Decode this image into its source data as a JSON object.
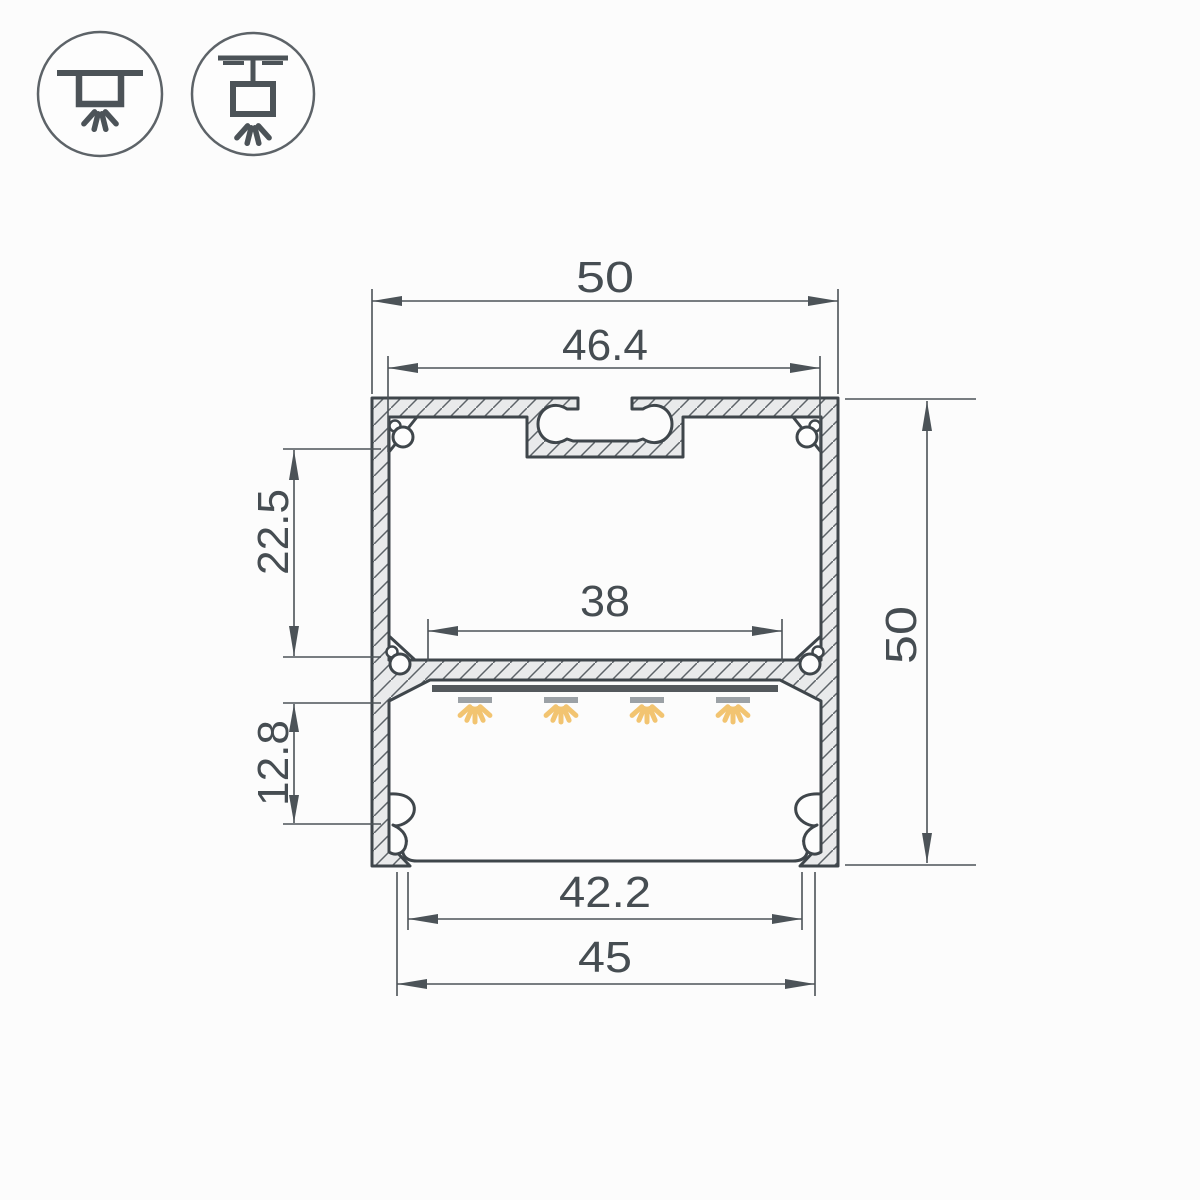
{
  "page": {
    "title": "Aluminium LED profile cross-section technical drawing"
  },
  "colors": {
    "background": "#fcfcfc",
    "outline": "#3f464b",
    "dimension_lines": "#4c5358",
    "dimension_text": "#464d52",
    "aluminum_fill": "#e9eaeb",
    "hatch_line": "#5d6368",
    "pcb_strip": "#54595d",
    "led_emitter": "#9ba1a6",
    "light_ray": "#f2c471",
    "icon_stroke": "#4c5358",
    "icon_circle": "#5d6368"
  },
  "icons": [
    {
      "name": "surface-mount"
    },
    {
      "name": "suspended-mount"
    }
  ],
  "dimensions": {
    "outer_width": "50",
    "top_opening_width": "46.4",
    "led_shelf_width": "38",
    "outer_height": "50",
    "upper_chamber_height": "22.5",
    "lower_chamber_height": "12.8",
    "diffuser_width": "42.2",
    "bottom_opening_width": "45"
  }
}
